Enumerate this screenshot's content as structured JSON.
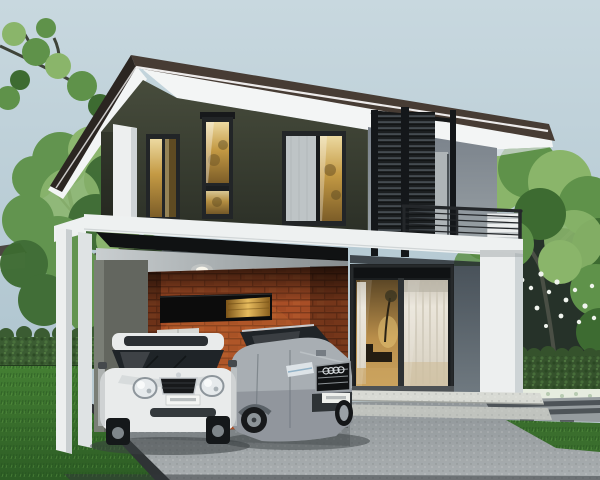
{
  "scene": {
    "type": "architectural-exterior-render",
    "description": "Photorealistic 3D rendering of a modern two-storey house with an open carport, two parked cars, front lawn, concrete driveway, hedges and trees under a pale blue-grey sky",
    "camera": "three-quarter front view"
  },
  "house": {
    "storeys": 2,
    "roof": "flat slab roof with deep white overhanging eaves, dark top edge and lit fascia line",
    "upper_wall": "dark olive-charcoal panelling",
    "right_wing_wall": "light grey render",
    "balcony": {
      "screens": "dark horizontal-louvre sliding panels",
      "railing": "black metal railing with thin horizontal bars",
      "corner_panel": "white louvre parapet panel"
    },
    "windows": [
      "upper corner glass door, warm light inside",
      "tall narrow two-pane window, warm light inside",
      "wide window half covered by a pale roller blind, lit pane at right"
    ],
    "carport": {
      "wall": "orange face-brick feature wall",
      "accent": "black horizontal panel with glowing amber slot window",
      "storage": "small white double-panel cabinet",
      "ceiling": "grey soffit with recessed downlight",
      "frame": "white portal posts and beam"
    },
    "entry": "sliding glass doors with sheer curtains and warm interior light",
    "steps": "speckled concrete entry steps, two treads"
  },
  "vehicles": [
    {
      "name": "white-hatchback",
      "style": "compact hatchback, front view",
      "color": "white",
      "plate": "small white plate, text illegible"
    },
    {
      "name": "silver-sedan",
      "style": "saloon, three-quarter front view, four-ring grille badge",
      "color": "silver-grey",
      "plate": "small white plate, text illegible"
    }
  ],
  "landscape": {
    "left": [
      "frangipani branch in top corner",
      "large leafy tree",
      "trimmed hedge",
      "lawn"
    ],
    "right": [
      "trees with white blossoms",
      "hedge with white flower bed",
      "slatted walkway",
      "lawn"
    ],
    "ground": [
      "concrete driveway",
      "dark kerb edging"
    ],
    "background": [
      "neighbouring rooftop at far left"
    ]
  },
  "colors": {
    "sky-top": "#c8d8df",
    "sky-mid": "#b2c7d1",
    "sky-low": "#c1ced3",
    "roof-top": "#473c34",
    "roof-edge": "#2b2521",
    "fascia": "#f3f5f5",
    "wall-dark": "#3b4033",
    "wall-dark-deep": "#2c3027",
    "wall-gray": "#8e969b",
    "louver-dark": "#1b1e20",
    "railing": "#24272a",
    "beam-white": "#eef1f1",
    "beam-shadow": "#101213",
    "ceiling": "#c9ced0",
    "brick": "#a84e26",
    "brick-dark": "#7e3a1c",
    "panel-black": "#0c0c0c",
    "panel-glow": "#d9a63c",
    "cabinet": "#d8d9d5",
    "glass-amber": "#c49a44",
    "blind": "#c7ccce",
    "frame-dark": "#222527",
    "curtain": "#eae5da",
    "interior-warm": "#b98e4a",
    "wall-slate": "#5a646b",
    "column-white": "#edefef",
    "step-top": "#d8dad4",
    "driveway": "#989ea1",
    "carport-floor": "#7e8487",
    "curb": "#2f3335",
    "lawn": "#3c7830",
    "lawn-dark": "#2c5c24",
    "hedge": "#3b5c32",
    "foliage-light": "#8ab56a",
    "foliage-mid": "#5f924a",
    "foliage-dark": "#3d6b31",
    "foliage-back": "#263229",
    "trunk": "#4e5348",
    "flower-white": "#f0f4ee",
    "car-white": "#e9ebeb",
    "car-silver": "#a8aeb3",
    "car-glass": "#1f2428",
    "chrome": "#ccd1d5",
    "shadow": "#3a3f42"
  }
}
